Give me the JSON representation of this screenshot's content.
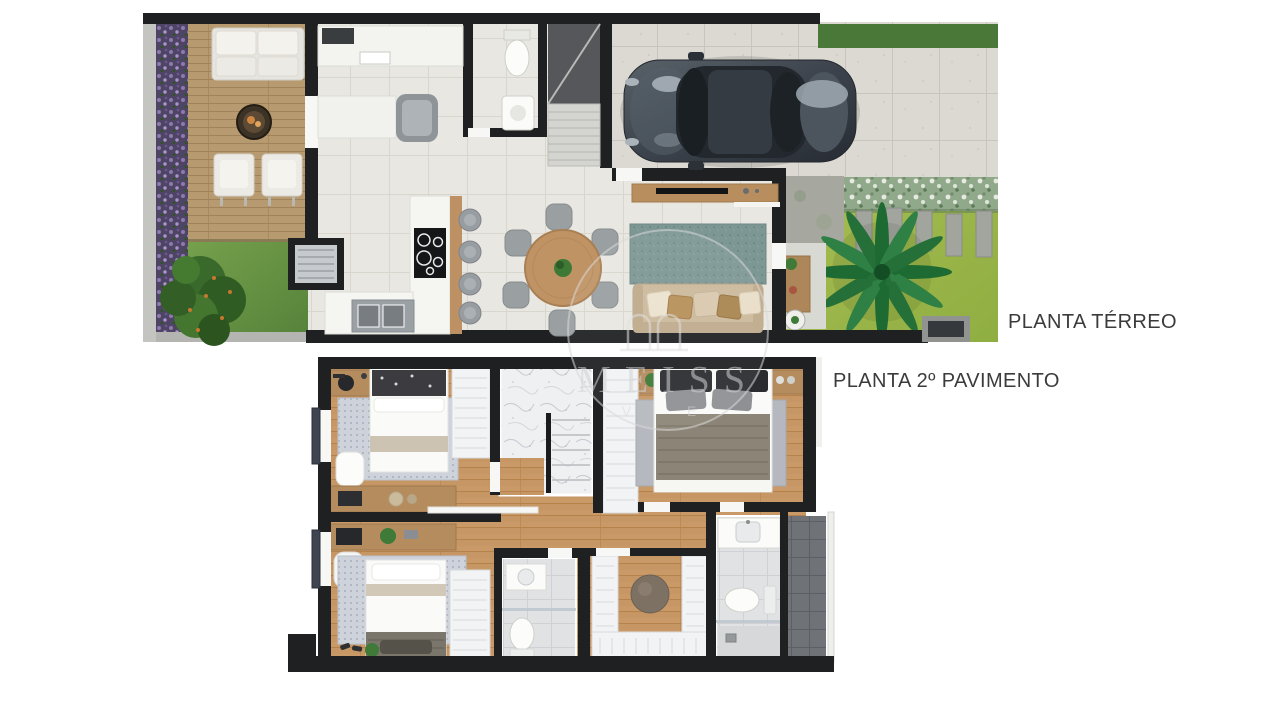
{
  "labels": {
    "ground_floor": "PLANTA TÉRREO",
    "second_floor": "PLANTA 2º PAVIMENTO"
  },
  "watermark": {
    "text": "MEISS",
    "subtext": "V E"
  },
  "palette": {
    "wall": "#1f2022",
    "interior_tile": "#e9e7e1",
    "driveway_tile": "#dbd9d2",
    "deck_wood": "#b79a70",
    "upper_wood": "#c99a68",
    "backyard_grass": "#6b9747",
    "front_grass": "#9db54a",
    "flower_bed": "#4e4565",
    "hedge": "#91a98b",
    "living_rug": "#7d9795",
    "sofa_beige": "#cdb99c",
    "car_body": "#3c434c",
    "marble": "#eef0f2",
    "bathroom_tile": "#e1e2e4",
    "balcony_tile": "#6f7378",
    "label_text": "#3b3b3b"
  }
}
